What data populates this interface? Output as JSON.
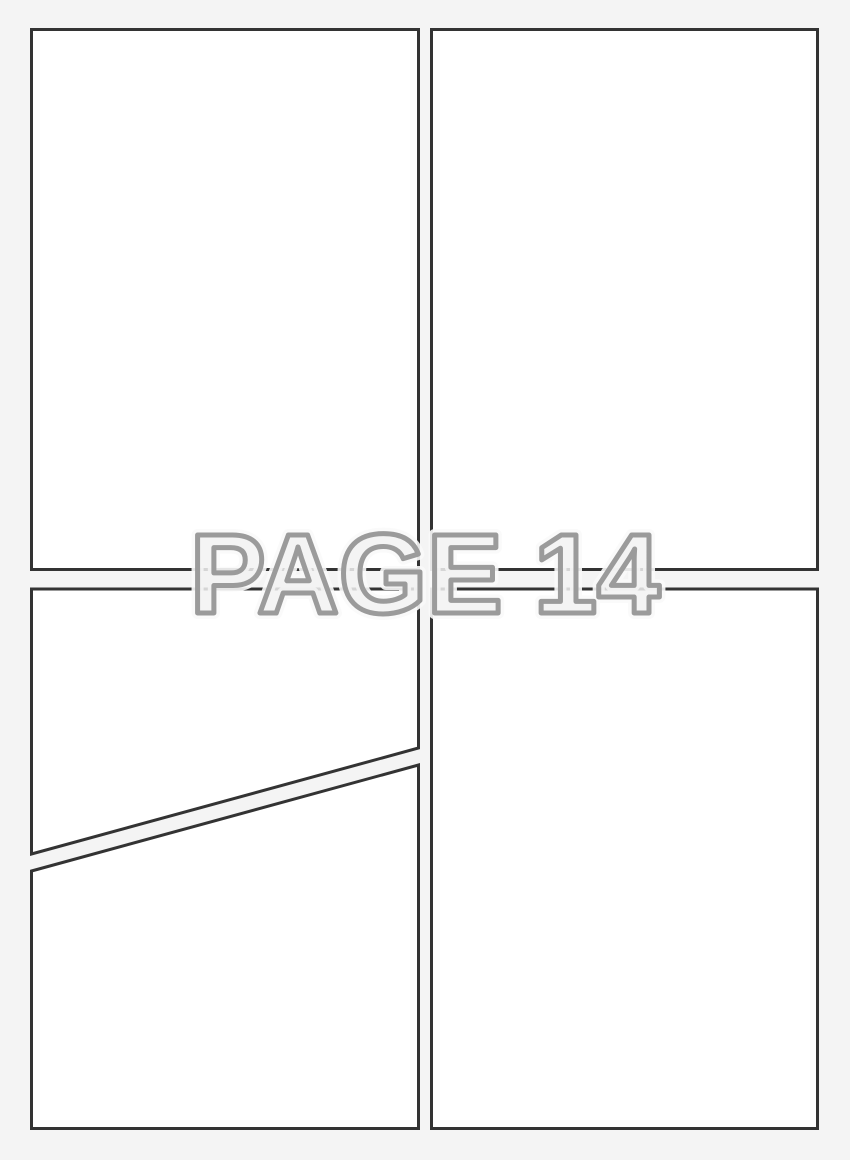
{
  "watermark": {
    "text": "PAGE 14"
  },
  "colors": {
    "page_bg": "#f4f4f4",
    "panel_fill": "#ffffff",
    "panel_border": "#333333",
    "watermark_stroke": "#9b9b9b",
    "watermark_fill": "#f2f2f2",
    "watermark_halo": "#fafafa"
  },
  "panels": [
    {
      "id": "top-left",
      "content": ""
    },
    {
      "id": "top-right",
      "content": ""
    },
    {
      "id": "bottom-left-upper",
      "content": ""
    },
    {
      "id": "bottom-left-lower",
      "content": ""
    },
    {
      "id": "bottom-right",
      "content": ""
    }
  ]
}
